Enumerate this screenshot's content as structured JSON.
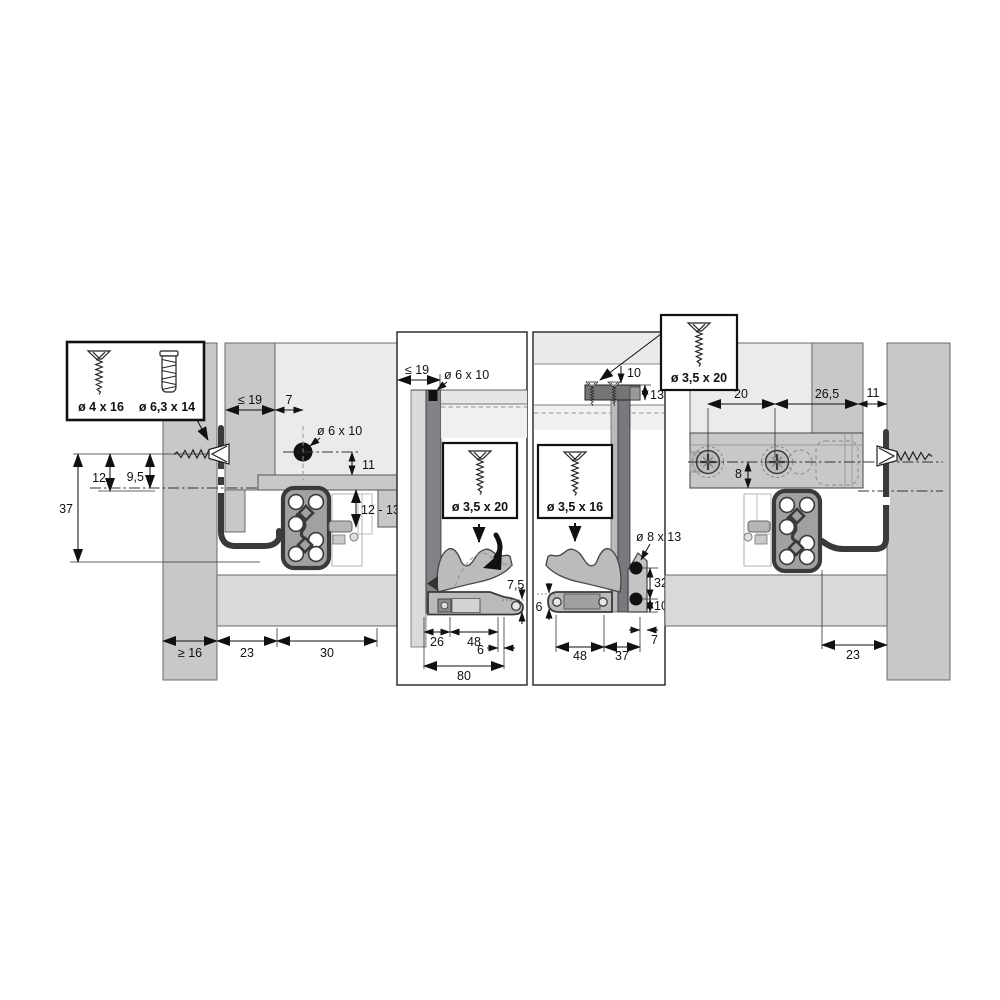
{
  "palette": {
    "panel_gray": "#c6c8ca",
    "panel_light": "#eaebec",
    "band_gray": "#d8d9da",
    "profile_dark": "#7d7f82",
    "line_black": "#1a1a1a"
  },
  "legend_box": {
    "screw1": "ø 4 x 16",
    "screw2": "ø 6,3 x 14"
  },
  "left_view": {
    "dims": {
      "panel_thickness": "≤ 19",
      "hole_offset": "7",
      "hole_spec": "ø 6 x 10",
      "top_clearance": "11",
      "front_drop": "12 - 13",
      "front_overlay": "12",
      "screw_axis": "9,5",
      "total_height": "37",
      "side_min": "≥ 16",
      "bottom_front": "23",
      "bottom_depth": "30"
    }
  },
  "front_section": {
    "dims": {
      "panel_thickness": "≤ 19",
      "hole_spec": "ø 6 x 10",
      "screw_spec": "ø 3,5 x 20",
      "runner_height": "7,5",
      "front_inset": "26",
      "screw_span": "48",
      "edge_gap": "6",
      "total_width": "80"
    }
  },
  "rear_section": {
    "dims": {
      "top_inset": "10",
      "bracket_height": "13",
      "screw_spec_top": "ø 3,5 x 20",
      "screw_spec": "ø 3,5 x 16",
      "hole_spec": "ø 8 x 13",
      "hole_spacing": "32",
      "hole_to_bottom": "10",
      "runner_height": "6",
      "screw_span": "48",
      "rear_span": "37",
      "edge_gap": "7"
    }
  },
  "right_view": {
    "dims": {
      "screw_spacing": "20",
      "bracket_depth": "26,5",
      "wall_gap": "11",
      "axis_offset": "8",
      "bottom_gap": "23"
    }
  }
}
